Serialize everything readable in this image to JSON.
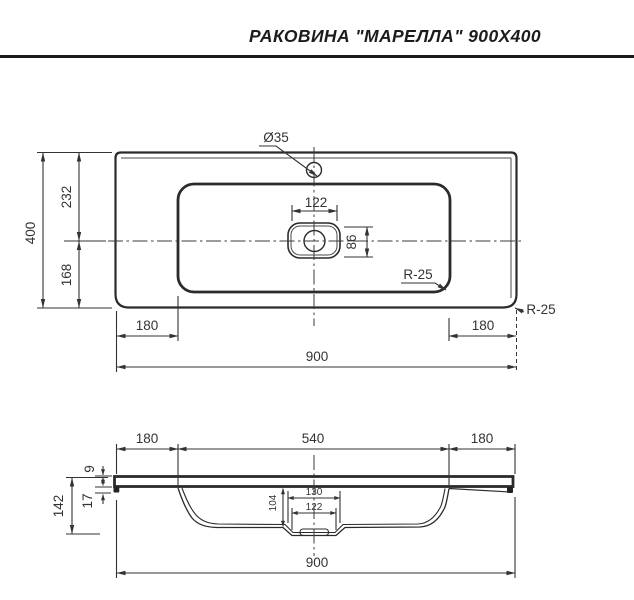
{
  "title": "РАКОВИНА \"МАРЕЛЛА\" 900X400",
  "plan": {
    "overall_width": "900",
    "overall_depth": "400",
    "back_to_drain": "232",
    "drain_to_front": "168",
    "left_offset": "180",
    "right_offset": "180",
    "faucet_hole_diameter": "Ø35",
    "drain_recess_width": "122",
    "drain_recess_depth": "86",
    "basin_corner_radius": "R-25",
    "outer_corner_radius": "R-25"
  },
  "section": {
    "left_offset": "180",
    "basin_width": "540",
    "right_offset": "180",
    "slab_thickness": "9",
    "front_edge_height": "17",
    "total_height": "142",
    "basin_depth": "104",
    "recess_outer_width": "130",
    "recess_inner_width": "122",
    "overall_width": "900"
  }
}
